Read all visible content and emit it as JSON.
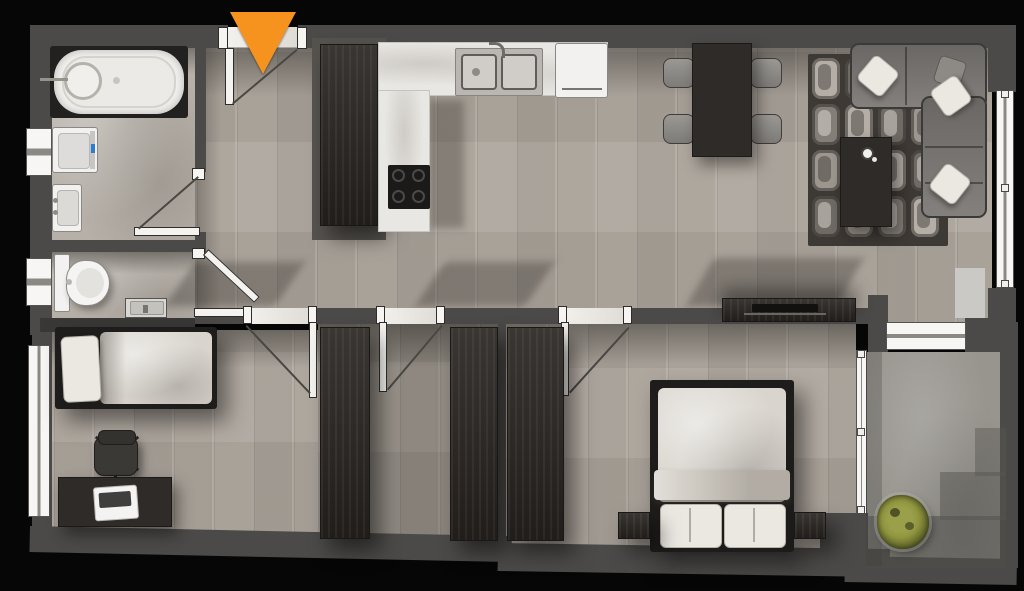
{
  "meta": {
    "kind": "apartment-floor-plan-render",
    "view": "top-down",
    "width_px": 1024,
    "height_px": 591
  },
  "colors": {
    "bg": "#060606",
    "wall": "#4c4a48",
    "wood": "#b2aba2",
    "marble": "#b6b0a8",
    "stone": "#98958f",
    "counter": "#e9e7e3",
    "dark_wood": "#2e2b28",
    "wardrobe": "#2b2723",
    "sofa": "#7b7875",
    "bedding": "#d9d5ce",
    "window_frame": "#f7f6f4",
    "marker": "#F6921E",
    "plant": "#8f943e"
  },
  "entrance": {
    "marker_shape": "triangle-pointing-down",
    "marker_color": "#F6921E",
    "location": "top-wall"
  },
  "rooms": [
    {
      "name": "bathroom",
      "floor": "marble",
      "furniture": [
        "bathtub",
        "washing-machine",
        "wash-basin"
      ],
      "windows": 2,
      "doors": 1
    },
    {
      "name": "wc",
      "floor": "marble",
      "furniture": [
        "toilet",
        "hand-basin"
      ],
      "windows": 1,
      "doors": 1
    },
    {
      "name": "kitchen",
      "floor": "wood",
      "furniture": [
        "tall-cabinet",
        "l-shaped-counter",
        "double-sink",
        "cooktop-4-burner",
        "refrigerator"
      ]
    },
    {
      "name": "dining-area",
      "floor": "wood",
      "furniture": [
        "dining-table",
        "chair",
        "chair",
        "chair",
        "chair"
      ]
    },
    {
      "name": "living-area",
      "floor": "wood",
      "furniture": [
        "corner-sofa",
        "pillow",
        "pillow",
        "pillow",
        "rug",
        "coffee-table",
        "cup",
        "tv-console"
      ],
      "windows": 1
    },
    {
      "name": "hallway",
      "floor": "wood",
      "doors": 4
    },
    {
      "name": "bedroom-1",
      "floor": "wood",
      "furniture": [
        "single-bed",
        "office-chair",
        "desk",
        "laptop"
      ],
      "windows": 1,
      "doors": 1
    },
    {
      "name": "closet-room",
      "floor": "wood",
      "furniture": [
        "wardrobe",
        "wardrobe"
      ],
      "doors": 1
    },
    {
      "name": "bedroom-2",
      "floor": "wood",
      "furniture": [
        "wardrobe",
        "double-bed",
        "nightstand",
        "nightstand"
      ],
      "doors": 1
    },
    {
      "name": "balcony",
      "floor": "stone",
      "furniture": [
        "plant"
      ],
      "doors": 2
    }
  ]
}
